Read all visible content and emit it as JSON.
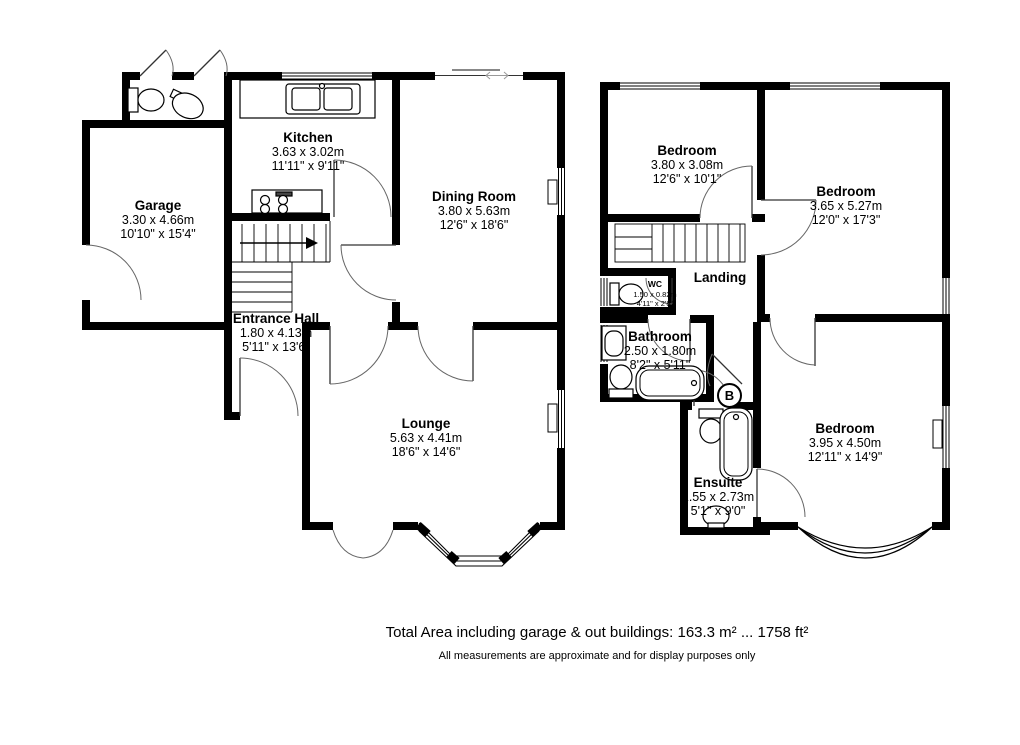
{
  "rooms": [
    {
      "name": "Garage",
      "metric": "3.30 x 4.66m",
      "imperial": "10'10\" x 15'4\""
    },
    {
      "name": "Kitchen",
      "metric": "3.63 x 3.02m",
      "imperial": "11'11\" x 9'11\""
    },
    {
      "name": "Dining Room",
      "metric": "3.80 x 5.63m",
      "imperial": "12'6\" x 18'6\""
    },
    {
      "name": "Entrance Hall",
      "metric": "1.80 x 4.13m",
      "imperial": "5'11\" x 13'6\""
    },
    {
      "name": "Lounge",
      "metric": "5.63 x 4.41m",
      "imperial": "18'6\" x 14'6\""
    },
    {
      "name": "Bedroom",
      "metric": "3.80 x 3.08m",
      "imperial": "12'6\" x 10'1\""
    },
    {
      "name": "Bedroom",
      "metric": "3.65 x 5.27m",
      "imperial": "12'0\" x 17'3\""
    },
    {
      "name": "Landing",
      "metric": "",
      "imperial": ""
    },
    {
      "name": "WC",
      "metric": "1.50 x 0.82m",
      "imperial": "4'11\" x 2'8\""
    },
    {
      "name": "Bathroom",
      "metric": "2.50 x 1.80m",
      "imperial": "8'2\" x 5'11\""
    },
    {
      "name": "Ensuite",
      "metric": "1.55 x 2.73m",
      "imperial": "5'1\" x 9'0\""
    },
    {
      "name": "Bedroom",
      "metric": "3.95 x 4.50m",
      "imperial": "12'11\" x 14'9\""
    }
  ],
  "markers": {
    "boiler": "B"
  },
  "footer": {
    "total_area": "Total Area including garage & out buildings: 163.3 m² ... 1758 ft²",
    "disclaimer": "All measurements are approximate and for display purposes only"
  },
  "colors": {
    "wall": "#000000",
    "background": "#ffffff",
    "text": "#000000"
  }
}
